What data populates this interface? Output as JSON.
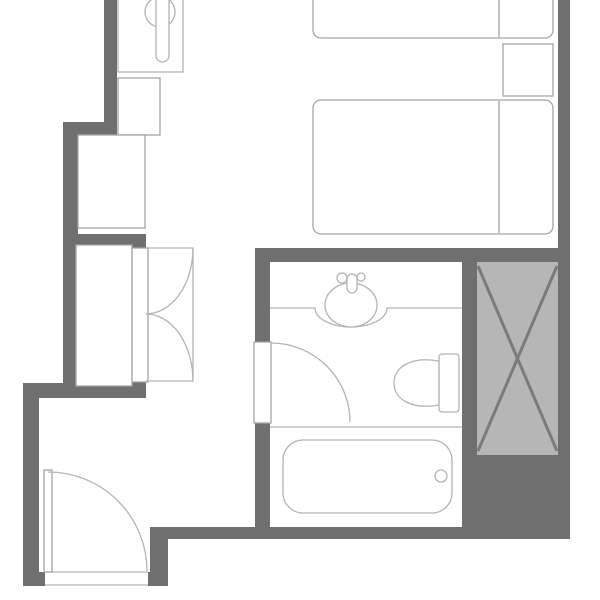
{
  "meta": {
    "title": "Hotel guest room floor plan",
    "canvas": {
      "width": 600,
      "height": 600
    }
  },
  "colors": {
    "background": "#ffffff",
    "white": "#ffffff",
    "wall": "#6f6f6f",
    "fixture": "#b4b4b4",
    "furniture": "#a4a4a4",
    "shaft_fill": "#b6b6b6",
    "shaft_line": "#7b7b7b"
  },
  "elements": [
    {
      "name": "wall-top-left-vertical",
      "kind": "rect",
      "x": 104,
      "y": 0,
      "w": 13,
      "h": 135,
      "fill": "wall",
      "stroke": "none"
    },
    {
      "name": "wall-upper-step",
      "kind": "rect",
      "x": 63,
      "y": 122,
      "w": 54,
      "h": 13,
      "fill": "wall",
      "stroke": "none"
    },
    {
      "name": "wall-left-upper",
      "kind": "rect",
      "x": 63,
      "y": 122,
      "w": 15,
      "h": 276,
      "fill": "wall",
      "stroke": "none"
    },
    {
      "name": "wall-closet-surround",
      "kind": "rect",
      "x": 63,
      "y": 234,
      "w": 83,
      "h": 164,
      "fill": "wall",
      "stroke": "none"
    },
    {
      "name": "wall-closet-bottom",
      "kind": "rect",
      "x": 23,
      "y": 383,
      "w": 123,
      "h": 15,
      "fill": "wall",
      "stroke": "none"
    },
    {
      "name": "wall-left-lower",
      "kind": "rect",
      "x": 23,
      "y": 383,
      "w": 16,
      "h": 203,
      "fill": "wall",
      "stroke": "none"
    },
    {
      "name": "wall-entry-left-stub",
      "kind": "rect",
      "x": 23,
      "y": 572,
      "w": 22,
      "h": 14,
      "fill": "wall",
      "stroke": "none"
    },
    {
      "name": "wall-entry-right-stub",
      "kind": "rect",
      "x": 148,
      "y": 572,
      "w": 20,
      "h": 14,
      "fill": "wall",
      "stroke": "none"
    },
    {
      "name": "wall-entry-step",
      "kind": "rect",
      "x": 150,
      "y": 527,
      "w": 18,
      "h": 59,
      "fill": "wall",
      "stroke": "none"
    },
    {
      "name": "wall-bottom-main",
      "kind": "rect",
      "x": 168,
      "y": 527,
      "w": 402,
      "h": 12,
      "fill": "wall",
      "stroke": "none"
    },
    {
      "name": "wall-under-shaft",
      "kind": "rect",
      "x": 462,
      "y": 455,
      "w": 108,
      "h": 84,
      "fill": "wall",
      "stroke": "none"
    },
    {
      "name": "wall-bathroom-left-upper",
      "kind": "rect",
      "x": 255,
      "y": 248,
      "w": 15,
      "h": 95,
      "fill": "wall",
      "stroke": "none"
    },
    {
      "name": "wall-bathroom-left-lower",
      "kind": "rect",
      "x": 255,
      "y": 422,
      "w": 15,
      "h": 105,
      "fill": "wall",
      "stroke": "none"
    },
    {
      "name": "wall-bedroom-bottom",
      "kind": "rect",
      "x": 255,
      "y": 248,
      "w": 315,
      "h": 14,
      "fill": "wall",
      "stroke": "none"
    },
    {
      "name": "wall-bathroom-right",
      "kind": "rect",
      "x": 462,
      "y": 262,
      "w": 15,
      "h": 193,
      "fill": "wall",
      "stroke": "none"
    },
    {
      "name": "wall-right-outer",
      "kind": "rect",
      "x": 558,
      "y": 0,
      "w": 12,
      "h": 455,
      "fill": "wall",
      "stroke": "none"
    },
    {
      "name": "shaft-box",
      "kind": "rect",
      "x": 477,
      "y": 262,
      "w": 81,
      "h": 193,
      "fill": "shaft_fill",
      "stroke": "none"
    },
    {
      "name": "shaft-diagonal-1",
      "kind": "line",
      "x1": 478,
      "y1": 266,
      "x2": 557,
      "y2": 451,
      "stroke": "shaft_line",
      "sw": 3
    },
    {
      "name": "shaft-diagonal-2",
      "kind": "line",
      "x1": 557,
      "y1": 266,
      "x2": 478,
      "y2": 451,
      "stroke": "shaft_line",
      "sw": 3
    },
    {
      "name": "utility-fixture-box",
      "kind": "rect",
      "x": 118,
      "y": -4,
      "w": 65,
      "h": 76,
      "fill": "white",
      "stroke": "fixture"
    },
    {
      "name": "utility-fixture-bowl",
      "kind": "circle",
      "cx": 160,
      "cy": 12,
      "r": 15,
      "fill": "white",
      "stroke": "fixture"
    },
    {
      "name": "utility-fixture-handle",
      "kind": "rect",
      "x": 156,
      "y": -8,
      "w": 13,
      "h": 70,
      "rx": 6.5,
      "fill": "white",
      "stroke": "fixture"
    },
    {
      "name": "cabinet-upper",
      "kind": "rect",
      "x": 118,
      "y": 78,
      "w": 42,
      "h": 57,
      "fill": "white",
      "stroke": "furniture"
    },
    {
      "name": "cabinet-lower",
      "kind": "rect",
      "x": 78,
      "y": 135,
      "w": 67,
      "h": 93,
      "fill": "white",
      "stroke": "furniture"
    },
    {
      "name": "closet-box",
      "kind": "rect",
      "x": 76,
      "y": 245,
      "w": 56,
      "h": 141,
      "fill": "white",
      "stroke": "furniture"
    },
    {
      "name": "closet-panel",
      "kind": "rect",
      "x": 132,
      "y": 248,
      "w": 16,
      "h": 134,
      "fill": "white",
      "stroke": "furniture"
    },
    {
      "name": "closet-door-frame",
      "kind": "path",
      "d": "M146,248 H193 V381 H146",
      "fill": "none",
      "stroke": "fixture"
    },
    {
      "name": "closet-door-arc-upper",
      "kind": "path",
      "d": "M146,314 A47,66 0 0 0 193,248",
      "fill": "none",
      "stroke": "fixture"
    },
    {
      "name": "closet-door-arc-lower",
      "kind": "path",
      "d": "M146,314 A47,67 0 0 1 193,381",
      "fill": "none",
      "stroke": "fixture"
    },
    {
      "name": "entry-door-threshold-outer",
      "kind": "line",
      "x1": 45,
      "y1": 572,
      "x2": 148,
      "y2": 572,
      "stroke": "fixture"
    },
    {
      "name": "entry-door-threshold-inner",
      "kind": "line",
      "x1": 45,
      "y1": 585,
      "x2": 148,
      "y2": 585,
      "stroke": "fixture"
    },
    {
      "name": "entry-door-leaf",
      "kind": "rect",
      "x": 44,
      "y": 470,
      "w": 8,
      "h": 102,
      "fill": "white",
      "stroke": "furniture"
    },
    {
      "name": "entry-door-arc",
      "kind": "path",
      "d": "M48,472 A99,99 0 0 1 147,571",
      "fill": "none",
      "stroke": "fixture"
    },
    {
      "name": "bathroom-door-leaf",
      "kind": "rect",
      "x": 254,
      "y": 342,
      "w": 17,
      "h": 81,
      "fill": "white",
      "stroke": "furniture"
    },
    {
      "name": "bathroom-door-arc",
      "kind": "path",
      "d": "M271,343 A79,79 0 0 1 350,422",
      "fill": "none",
      "stroke": "fixture"
    },
    {
      "name": "vanity-counter",
      "kind": "path",
      "d": "M270,308 H315 A36,19 0 0 0 387,308 H462",
      "fill": "none",
      "stroke": "fixture"
    },
    {
      "name": "sink-basin",
      "kind": "ellipse",
      "cx": 351,
      "cy": 305,
      "rx": 26,
      "ry": 22,
      "fill": "white",
      "stroke": "fixture"
    },
    {
      "name": "faucet-handle",
      "kind": "rect",
      "x": 347,
      "y": 274,
      "w": 10,
      "h": 19,
      "rx": 5,
      "fill": "white",
      "stroke": "fixture"
    },
    {
      "name": "faucet-knob-left",
      "kind": "circle",
      "cx": 342,
      "cy": 278,
      "r": 5,
      "fill": "white",
      "stroke": "fixture"
    },
    {
      "name": "faucet-knob-right",
      "kind": "circle",
      "cx": 361,
      "cy": 277,
      "r": 4,
      "fill": "white",
      "stroke": "fixture"
    },
    {
      "name": "toilet-tank",
      "kind": "rect",
      "x": 439,
      "y": 354,
      "w": 20,
      "h": 58,
      "rx": 3,
      "fill": "white",
      "stroke": "fixture"
    },
    {
      "name": "toilet-bowl",
      "kind": "path",
      "d": "M439,361 C411,356 394,367 394,383 C394,399 411,410 439,405 Z",
      "fill": "white",
      "stroke": "fixture"
    },
    {
      "name": "bath-zone-divider",
      "kind": "line",
      "x1": 270,
      "y1": 427,
      "x2": 462,
      "y2": 427,
      "stroke": "fixture"
    },
    {
      "name": "bathtub",
      "kind": "rect",
      "x": 283,
      "y": 440,
      "w": 169,
      "h": 73,
      "rx": 20,
      "fill": "white",
      "stroke": "fixture"
    },
    {
      "name": "bathtub-drain",
      "kind": "circle",
      "cx": 441,
      "cy": 476,
      "r": 6,
      "fill": "white",
      "stroke": "fixture"
    },
    {
      "name": "bed-1",
      "kind": "rect",
      "x": 313,
      "y": -14,
      "w": 240,
      "h": 52,
      "rx": 8,
      "fill": "white",
      "stroke": "furniture"
    },
    {
      "name": "bed-1-pillow-line",
      "kind": "line",
      "x1": 499,
      "y1": -2,
      "x2": 499,
      "y2": 37,
      "stroke": "furniture"
    },
    {
      "name": "nightstand",
      "kind": "rect",
      "x": 503,
      "y": 44,
      "w": 50,
      "h": 52,
      "fill": "white",
      "stroke": "furniture"
    },
    {
      "name": "bed-2",
      "kind": "rect",
      "x": 313,
      "y": 100,
      "w": 240,
      "h": 134,
      "rx": 8,
      "fill": "white",
      "stroke": "furniture"
    },
    {
      "name": "bed-2-pillow-line",
      "kind": "line",
      "x1": 499,
      "y1": 101,
      "x2": 499,
      "y2": 233,
      "stroke": "furniture"
    }
  ]
}
